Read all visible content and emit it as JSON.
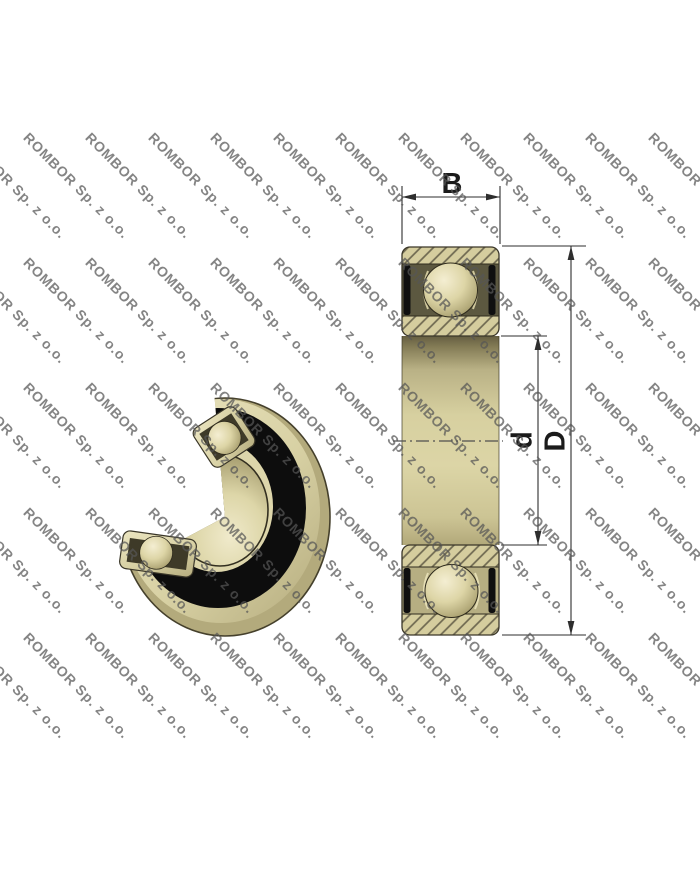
{
  "title": "Ball bearing technical drawing",
  "watermark": {
    "text": "ROMBOR Sp. z o.o.",
    "color": "#565656"
  },
  "figure_3d": {
    "description": "3D cutaway render of sealed deep-groove ball bearing"
  },
  "section_view": {
    "description": "Axial cross-section of bearing with dimension lines",
    "labels": {
      "width": "B",
      "bore": "d",
      "outer": "D"
    }
  },
  "colors": {
    "background": "#ffffff",
    "ring_tan": "#d5cd9e",
    "hatch_line": "#6e6850",
    "pocket_dark": "#514c36",
    "seal_black": "#0d0d0d",
    "ball_highlight": "#f4eed2",
    "ball_shadow": "#968d5f",
    "dimension_line": "#2e2e2e",
    "watermark_gray": "#565656"
  }
}
